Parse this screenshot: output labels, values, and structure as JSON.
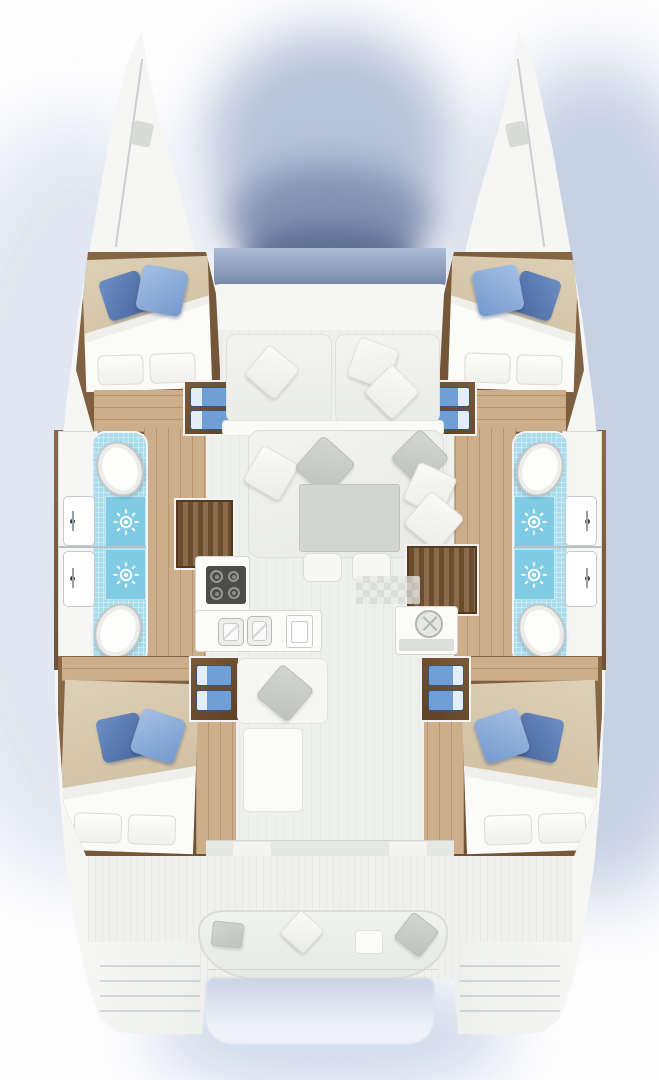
{
  "image": {
    "type": "floor-plan",
    "subject": "Catamaran sailing yacht interior layout, top-down plan view",
    "text_labels": []
  },
  "counts": {
    "cabins": 4,
    "toilets": 4,
    "showers": 4,
    "washbasins": 4,
    "galley_burners": 4
  },
  "layout": {
    "bow": [
      "port-bow",
      "starboard-bow",
      "foredeck-band",
      "front-window-band"
    ],
    "forward_cabins": [
      {
        "side": "port",
        "fixtures": [
          "double-bed",
          "blue-pillows",
          "white-pillows",
          "storage-steps-2-drawers"
        ]
      },
      {
        "side": "starboard",
        "fixtures": [
          "double-bed",
          "blue-pillows",
          "white-pillows",
          "storage-steps-2-drawers"
        ]
      }
    ],
    "heads": [
      {
        "side": "port",
        "position": "forward",
        "fixtures": [
          "toilet",
          "shower",
          "washbasin"
        ]
      },
      {
        "side": "port",
        "position": "aft",
        "fixtures": [
          "toilet",
          "shower",
          "washbasin"
        ]
      },
      {
        "side": "starboard",
        "position": "forward",
        "fixtures": [
          "toilet",
          "shower",
          "washbasin"
        ]
      },
      {
        "side": "starboard",
        "position": "aft",
        "fixtures": [
          "toilet",
          "shower",
          "washbasin"
        ]
      }
    ],
    "salon": {
      "fixtures": [
        "forward-bench",
        "u-shaped-sofa",
        "coffee-table",
        "two-ottomans",
        "throw-pillows",
        "aft-seat",
        "low-table",
        "floor-hatch"
      ]
    },
    "galley": {
      "port": [
        "four-burner-stove",
        "double-sink",
        "oven"
      ],
      "starboard": [
        "counter",
        "round-sink"
      ]
    },
    "aft_cabins": [
      {
        "side": "port",
        "fixtures": [
          "double-bed",
          "blue-pillows",
          "white-pillows",
          "storage-steps-2-drawers"
        ]
      },
      {
        "side": "starboard",
        "fixtures": [
          "double-bed",
          "blue-pillows",
          "white-pillows",
          "storage-steps-2-drawers"
        ]
      }
    ],
    "cockpit": {
      "fixtures": [
        "curved-stern-bench",
        "throw-pillows",
        "small-table",
        "swim-platform-port",
        "swim-platform-starboard"
      ]
    }
  },
  "colors": {
    "hull": "#f6f7f5",
    "interior": "#eef0ed",
    "cockpit": "#f0f1ee",
    "wood_dark": "#7d5d3c",
    "wood_light": "#ccae8b",
    "blanket": "#d5c3a6",
    "bedding": "#fafaf8",
    "pillow_blue_dark": "#4f73ad",
    "pillow_blue_light": "#86a7d6",
    "tile": "#a9dcec",
    "shower": "#7fcce4",
    "drawer_blue": "#6f9fd4",
    "table": "#d3d5d1",
    "stove": "#4c4c4a",
    "window_band": "#6e80a3",
    "wash_light": "#dde4f0",
    "wash_mid": "#b7c3da",
    "wash_dark": "#5f7095"
  }
}
